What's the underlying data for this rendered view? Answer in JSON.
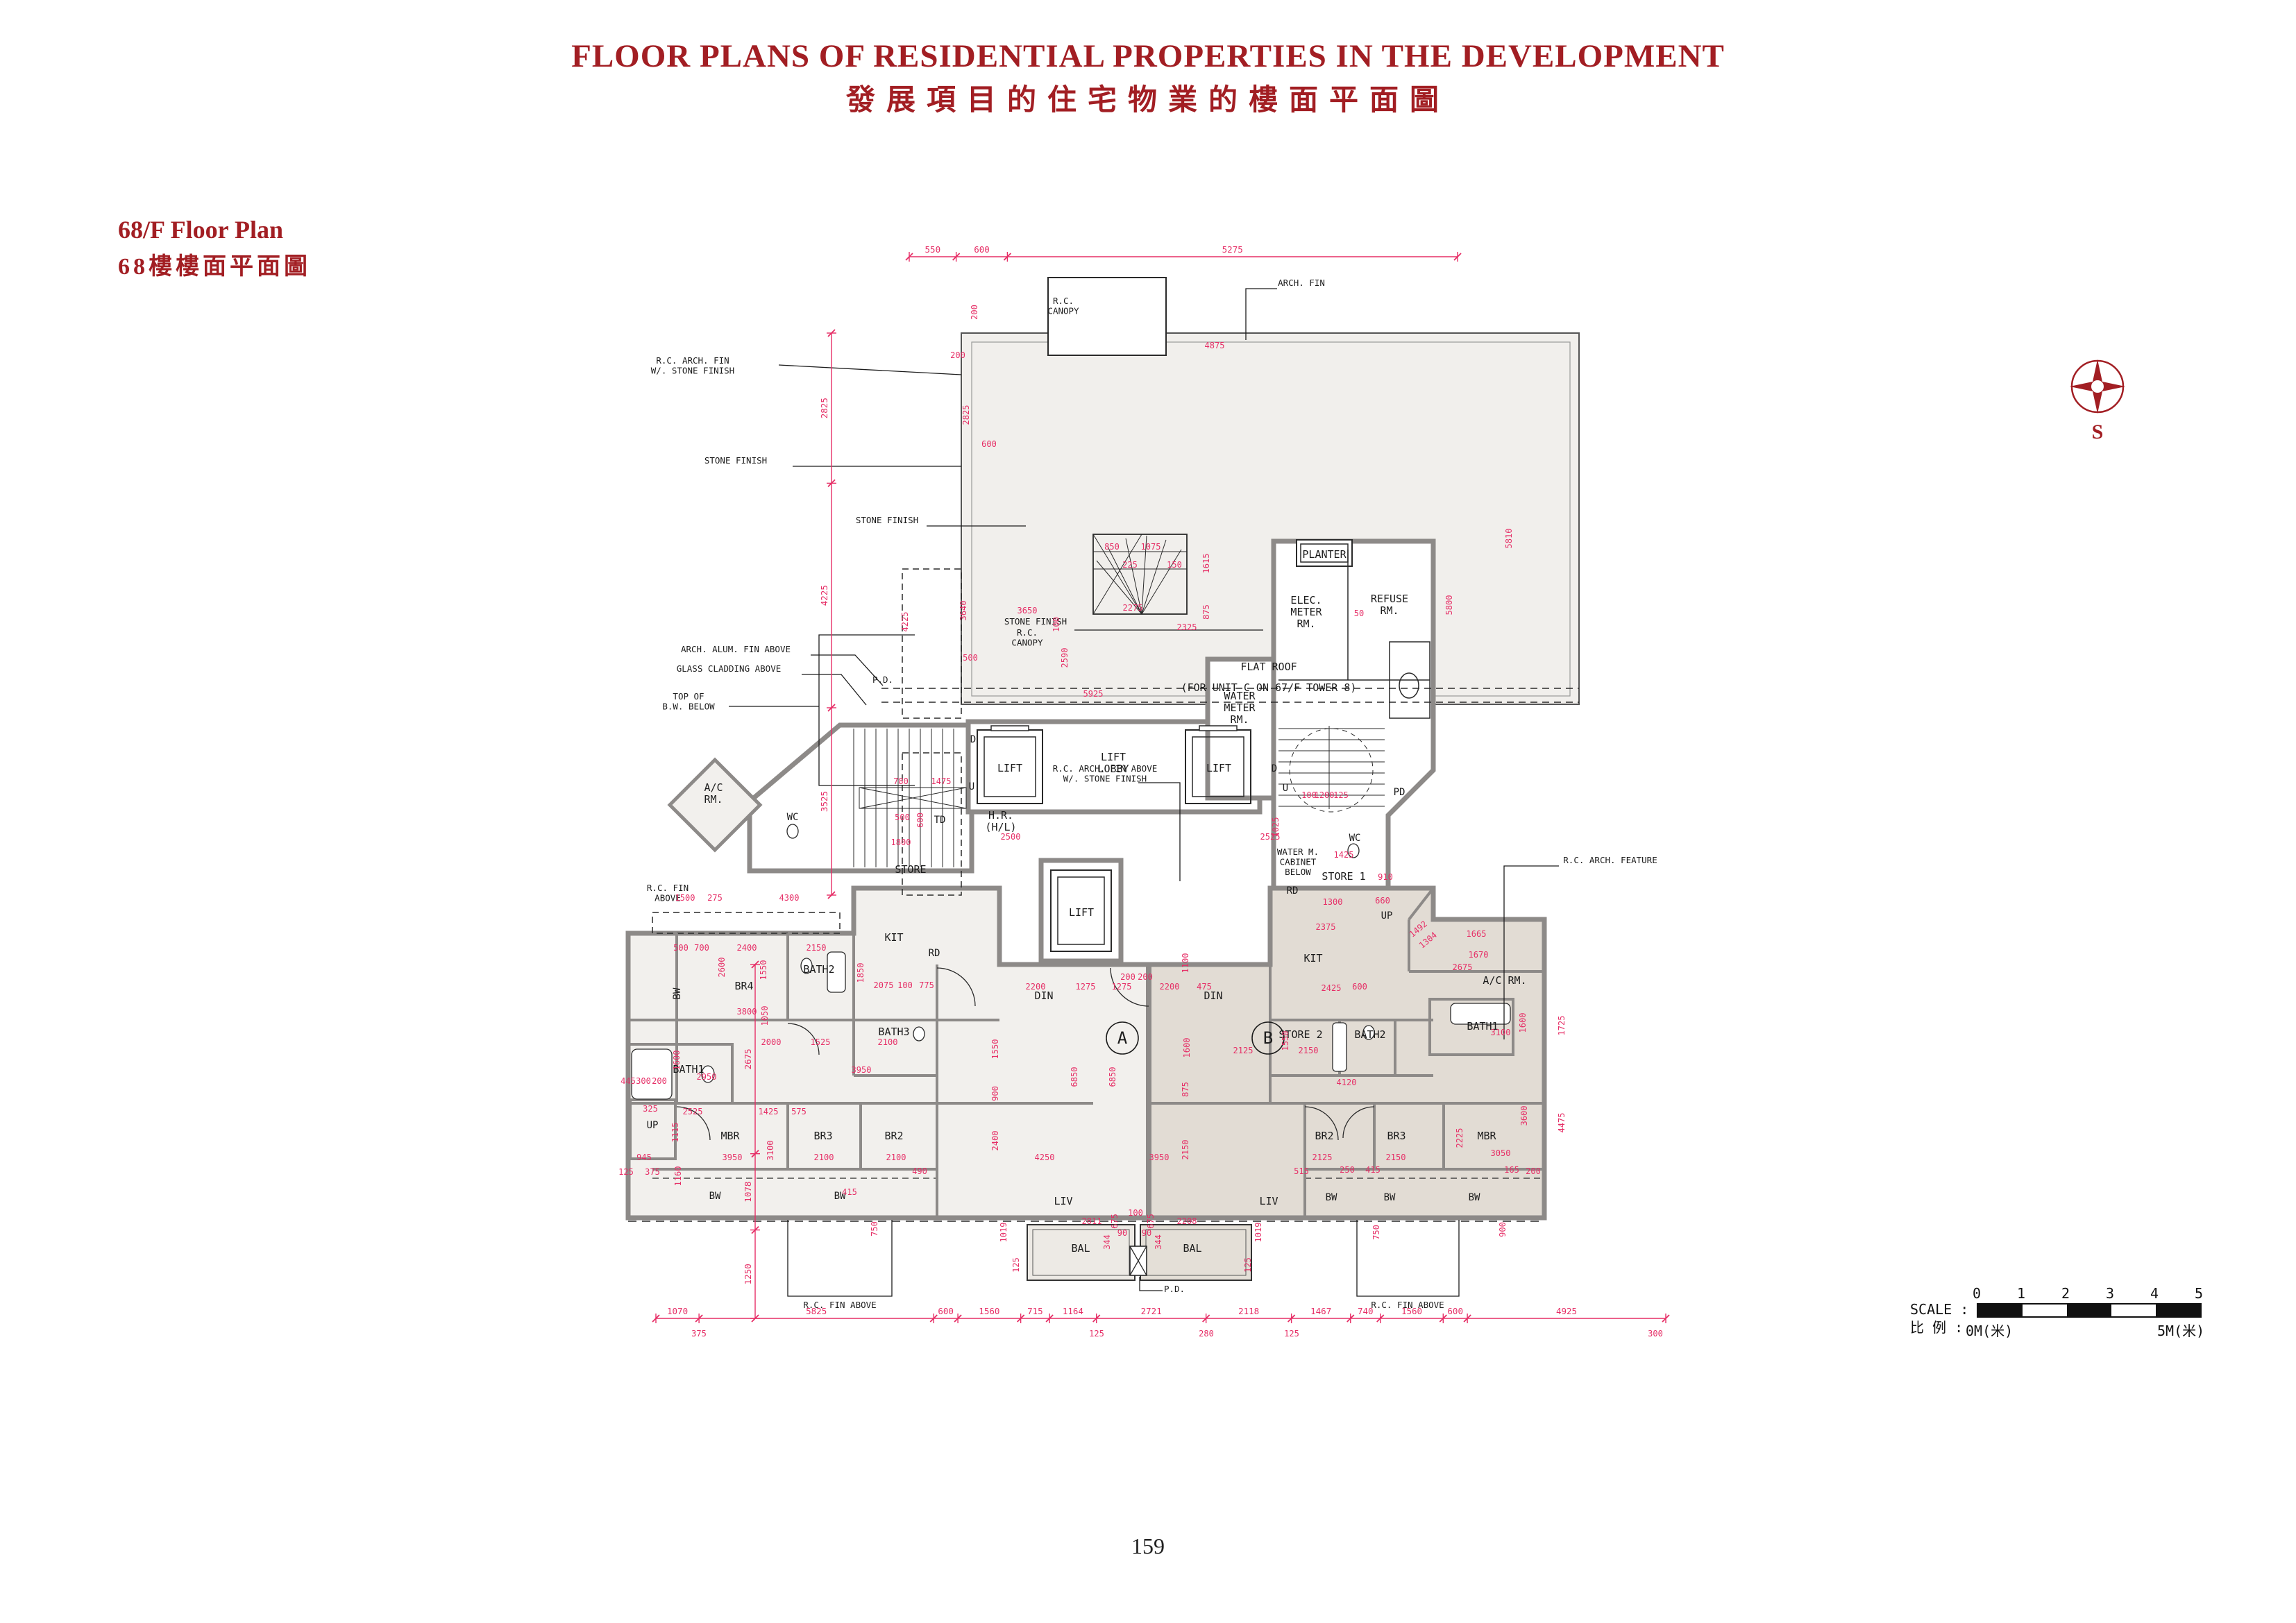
{
  "header": {
    "title_en": "FLOOR PLANS OF RESIDENTIAL PROPERTIES IN THE DEVELOPMENT",
    "title_zh": "發展項目的住宅物業的樓面平面圖"
  },
  "plan_header": {
    "title_en": "68/F Floor Plan",
    "title_zh": "68樓樓面平面圖"
  },
  "compass": {
    "south_label": "S"
  },
  "scale_bar": {
    "label_en": "SCALE :",
    "label_zh": "比 例 :",
    "ticks": [
      "0",
      "1",
      "2",
      "3",
      "4",
      "5"
    ],
    "start_label": "0M(米)",
    "end_label": "5M(米)"
  },
  "footer": {
    "page_number": "159"
  },
  "colors": {
    "accent_red": "#A21E23",
    "dim_pink": "#E62E66",
    "wall_gray": "#8D8A88",
    "fill_unit_a": "#F2F0ED",
    "fill_unit_b": "#E2DCD4",
    "fill_flat_roof": "#F1EFEC",
    "line_black": "#1C1C1C"
  },
  "plan": {
    "unit_labels": [
      "A",
      "B"
    ],
    "room_labels": [
      "FLAT ROOF",
      "(FOR UNIT C ON 67/F TOWER 8)",
      "ELEC.\nMETER\nRM.",
      "REFUSE\nRM.",
      "WATER\nMETER\nRM.",
      "PLANTER",
      "LIFT",
      "LIFT\nLOBBY",
      "LIFT",
      "LIFT",
      "KIT",
      "BATH2",
      "BR4",
      "BW",
      "BATH3",
      "BATH1",
      "DIN",
      "DIN",
      "MBR",
      "BR3",
      "BR2",
      "LIV",
      "LIV",
      "BAL",
      "BAL",
      "BW",
      "BW",
      "BW",
      "BW",
      "BW",
      "KIT",
      "STORE 2",
      "BATH2",
      "BATH1",
      "BR2",
      "BR3",
      "MBR",
      "STORE",
      "STORE 1",
      "A/C\nRM.",
      "A/C RM.",
      "WC",
      "WC",
      "TD",
      "H.R.\n(H/L)",
      "UP",
      "UP",
      "RD",
      "RD",
      "PD",
      "D",
      "U",
      "D",
      "U"
    ],
    "callouts": [
      "ARCH. FIN",
      "R.C.\nCANOPY",
      "R.C. ARCH. FIN\nW/. STONE FINISH",
      "STONE FINISH",
      "TOP OF\nB.W. BELOW",
      "R.C. ARCH. FIN ABOVE\nW/. STONE FINISH",
      "STONE FINISH",
      "STONE FINISH",
      "ARCH. ALUM. FIN ABOVE",
      "GLASS CLADDING ABOVE",
      "P.D.",
      "R.C.\nCANOPY",
      "WATER M.\nCABINET\nBELOW",
      "R.C. ARCH. FEATURE",
      "R.C. FIN\nABOVE",
      "R.C. FIN ABOVE",
      "R.C. FIN ABOVE",
      "P.D."
    ],
    "dim_chains": {
      "top": [
        "550",
        "600",
        "5275"
      ],
      "bottom": [
        "1070",
        "5825",
        "600",
        "1560",
        "715",
        "1164",
        "2721",
        "2118",
        "1467",
        "740",
        "1560",
        "600",
        "4925"
      ],
      "bottom_sub": [
        "375",
        "125",
        "280",
        "125",
        "300"
      ],
      "left": [
        "2825",
        "4225",
        "3525"
      ],
      "left_inner": [
        "2675",
        "1078",
        "1250"
      ]
    },
    "dims": [
      "4875",
      "200",
      "2825",
      "600",
      "5800",
      "5810",
      "4225",
      "2325",
      "50",
      "1615",
      "875",
      "3650",
      "2590",
      "5925",
      "2275",
      "100",
      "3640",
      "850",
      "1075",
      "225",
      "150",
      "780",
      "1475",
      "500",
      "600",
      "1800",
      "2500",
      "2525",
      "1025",
      "100",
      "1200",
      "125",
      "2375",
      "2425",
      "1300",
      "1425",
      "660",
      "910",
      "2675",
      "1670",
      "1665",
      "1492",
      "1304",
      "1725",
      "3100",
      "1600",
      "4475",
      "3600",
      "2225",
      "3050",
      "2150",
      "2125",
      "4120",
      "3950",
      "4250",
      "6850",
      "6850",
      "2200",
      "1275",
      "1275",
      "2200",
      "475",
      "600",
      "1100",
      "1600",
      "875",
      "2150",
      "900",
      "1550",
      "2400",
      "1019",
      "1019",
      "125",
      "125",
      "2811",
      "2208",
      "675",
      "675",
      "344",
      "344",
      "100",
      "90",
      "90",
      "200",
      "200",
      "1500",
      "275",
      "4300",
      "500",
      "700",
      "2400",
      "2150",
      "2600",
      "1550",
      "1850",
      "2075",
      "100",
      "775",
      "3800",
      "1050",
      "2000",
      "1525",
      "2100",
      "3950",
      "2950",
      "1600",
      "2525",
      "1425",
      "575",
      "1115",
      "945",
      "375",
      "125",
      "3100",
      "2100",
      "2100",
      "3950",
      "1160",
      "445",
      "300",
      "200",
      "325",
      "415",
      "490",
      "750",
      "750",
      "515",
      "250",
      "415",
      "165",
      "200",
      "900",
      "2125",
      "2150",
      "1550",
      "200",
      "500"
    ]
  }
}
